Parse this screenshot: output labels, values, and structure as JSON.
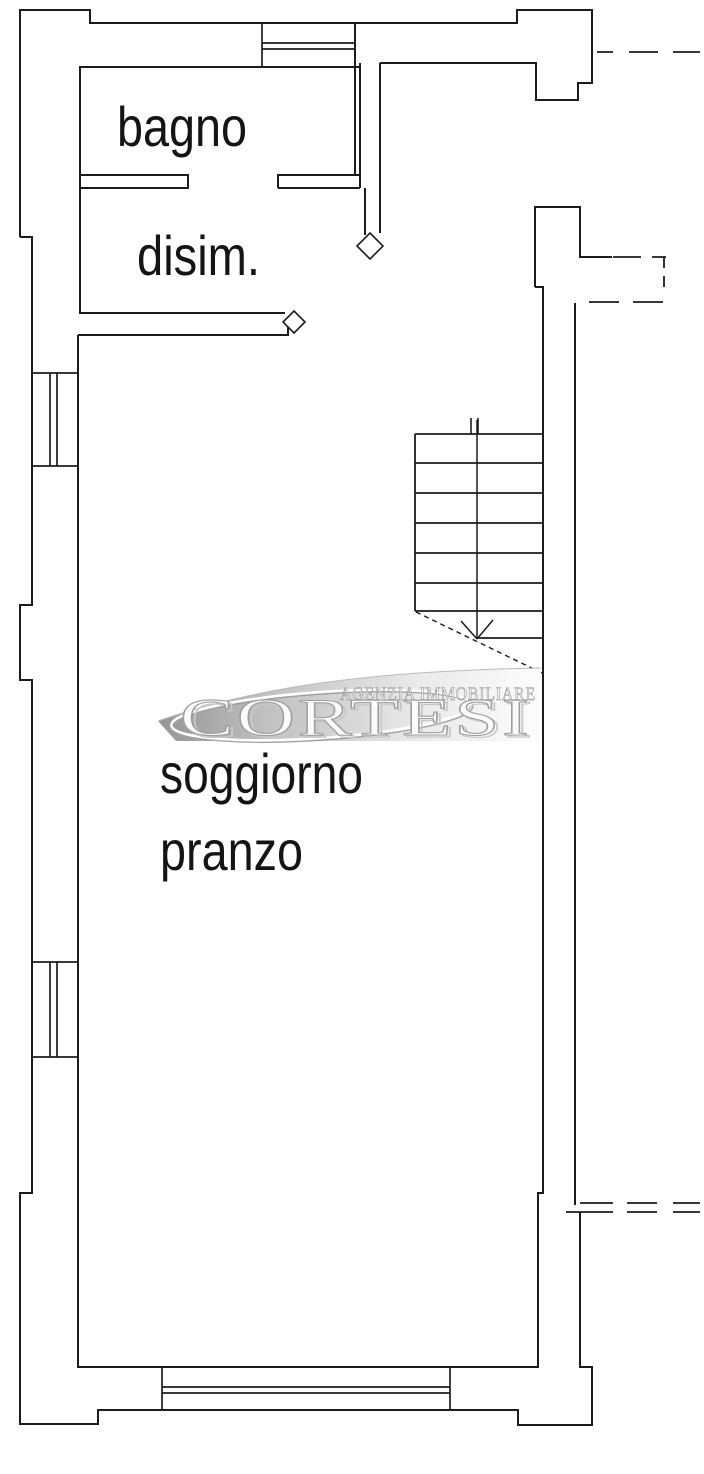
{
  "page": {
    "background": "#ffffff"
  },
  "plan": {
    "rooms": [
      {
        "label": "bagno"
      },
      {
        "label": "disim."
      },
      {
        "label": "soggiorno"
      },
      {
        "label": "pranzo"
      }
    ],
    "stairs": {
      "tread_count": 7,
      "direction_symbol": "down-arrow"
    }
  },
  "watermark": {
    "agency_line": "AGENZIA IMMOBILIARE",
    "brand": "CORTESI",
    "band_dark": "#8f8f8f",
    "band_light": "#fdfdfd"
  },
  "colors": {
    "line": "#1c1c1c"
  }
}
